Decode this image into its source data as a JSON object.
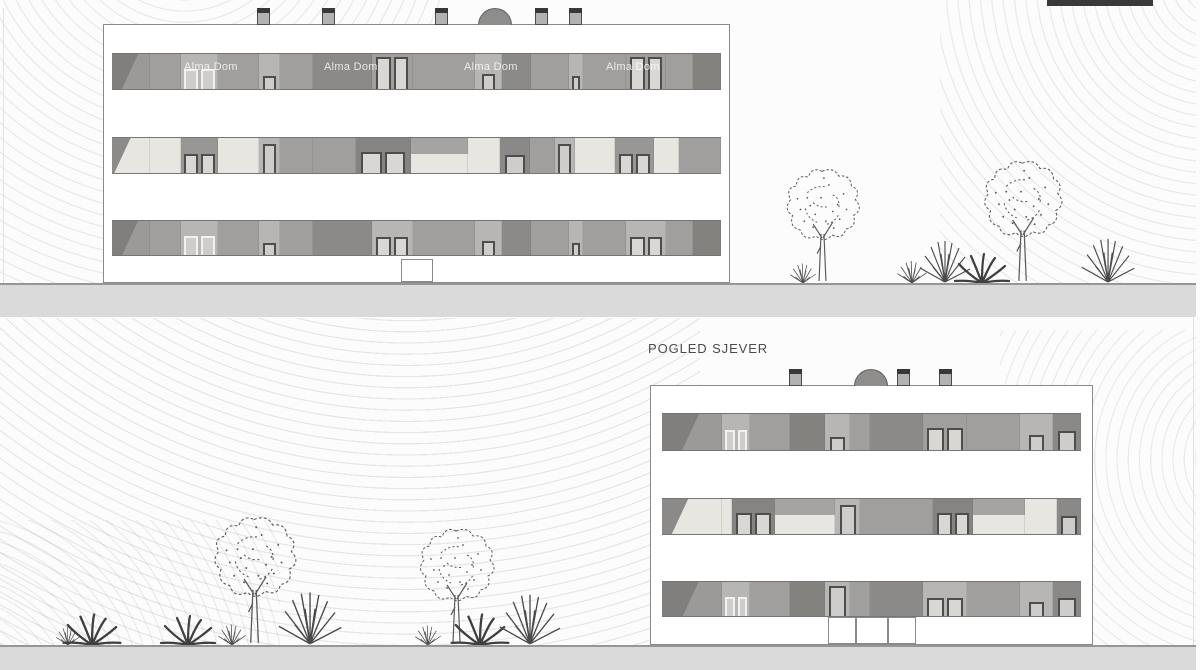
{
  "meta": {
    "view_label": "POGLED SJEVER",
    "watermark": "Alma Dom"
  },
  "palette": {
    "ground": "#dadada",
    "groundline": "#969696",
    "outline": "#8a8a8a",
    "bandline": "#757575",
    "dark": "#8b8a88",
    "med": "#a09f9d",
    "light": "#b7b6b4",
    "cream": "#e8e6e1",
    "gray": "#989795",
    "darktop": "#83827f",
    "darkstrip": "#8a8988",
    "darktopwp": "#858482",
    "framew": "#f2f1ef",
    "framed": "#4e4d4b",
    "glass": "#cecdcb",
    "glass2": "#d8d7d4",
    "cropbar": "#3a3a3a"
  },
  "ground_bands": [
    {
      "y": 283,
      "h": 34
    },
    {
      "y": 645,
      "h": 25
    }
  ],
  "label_pos": {
    "x": 648,
    "y": 341
  },
  "cropped_bar": {
    "x": 1047,
    "width": 106,
    "height": 6
  },
  "buildings": [
    {
      "name": "south-elevation",
      "left": 103,
      "top": 24,
      "width": 627,
      "height": 259,
      "inset": 8,
      "base_top": 231,
      "roof": {
        "chimneys": [
          153,
          218,
          331,
          431,
          465
        ],
        "dome": 391
      },
      "doors": [
        {
          "x": 0.474,
          "w": 0.051,
          "top": 234
        }
      ],
      "watermarks": [
        {
          "x": 80,
          "y": 36
        },
        {
          "x": 220,
          "y": 36
        },
        {
          "x": 360,
          "y": 36
        },
        {
          "x": 502,
          "y": 36
        }
      ],
      "floors": [
        {
          "y": 28,
          "h": 37,
          "segments": [
            [
              38,
              "darkdiag"
            ],
            [
              31,
              "med"
            ],
            [
              38,
              "light_wp_low"
            ],
            [
              41,
              "med"
            ],
            [
              21,
              "strip_sm"
            ],
            [
              33,
              "med"
            ],
            [
              59,
              "dark"
            ],
            [
              41,
              "wp_tall"
            ],
            [
              63,
              "med"
            ],
            [
              27,
              "light_wsm"
            ],
            [
              29,
              "dark"
            ],
            [
              38,
              "med"
            ],
            [
              14,
              "strip_sm"
            ],
            [
              44,
              "med"
            ],
            [
              40,
              "wp_tall"
            ],
            [
              27,
              "med"
            ],
            [
              28,
              "darktop"
            ]
          ]
        },
        {
          "y": 112,
          "h": 37,
          "segments": [
            [
              38,
              "creamdiag"
            ],
            [
              31,
              "cream"
            ],
            [
              38,
              "gray_wp_low"
            ],
            [
              41,
              "cream"
            ],
            [
              21,
              "strip_tl"
            ],
            [
              33,
              "med"
            ],
            [
              43,
              "med"
            ],
            [
              55,
              "darktop_wp"
            ],
            [
              58,
              "creamgray"
            ],
            [
              32,
              "cream"
            ],
            [
              30,
              "strip_mid"
            ],
            [
              25,
              "med"
            ],
            [
              20,
              "strip_tl"
            ],
            [
              40,
              "cream"
            ],
            [
              40,
              "gray_wp_low"
            ],
            [
              25,
              "cream"
            ],
            [
              42,
              "med"
            ]
          ]
        },
        {
          "y": 195,
          "h": 36,
          "segments": [
            [
              38,
              "darkdiag"
            ],
            [
              31,
              "med"
            ],
            [
              38,
              "light_wp_low"
            ],
            [
              41,
              "med"
            ],
            [
              21,
              "strip_sm"
            ],
            [
              33,
              "med"
            ],
            [
              59,
              "dark"
            ],
            [
              41,
              "wp_low_dark"
            ],
            [
              63,
              "med"
            ],
            [
              27,
              "light_wsm"
            ],
            [
              29,
              "dark"
            ],
            [
              38,
              "med"
            ],
            [
              14,
              "strip_sm"
            ],
            [
              44,
              "med"
            ],
            [
              40,
              "wp_low_dark"
            ],
            [
              27,
              "med"
            ],
            [
              28,
              "darktop"
            ]
          ]
        }
      ]
    },
    {
      "name": "north-elevation",
      "left": 650,
      "top": 385,
      "width": 443,
      "height": 260,
      "inset": 11,
      "base_top": 231,
      "roof": {
        "chimneys": [
          138,
          246,
          288
        ],
        "dome": 220
      },
      "doors": [
        {
          "x": 0.3995,
          "w": 0.0633,
          "top": 231
        },
        {
          "x": 0.4628,
          "w": 0.0722,
          "top": 231
        },
        {
          "x": 0.535,
          "w": 0.0632,
          "top": 231
        }
      ],
      "watermarks": [],
      "floors": [
        {
          "y": 27,
          "h": 38,
          "segments": [
            [
              60,
              "darkdiag"
            ],
            [
              28,
              "light_wp_low"
            ],
            [
              40,
              "med"
            ],
            [
              35,
              "darktop"
            ],
            [
              25,
              "strip_sm"
            ],
            [
              20,
              "med"
            ],
            [
              53,
              "dark"
            ],
            [
              44,
              "wp_mid"
            ],
            [
              53,
              "med"
            ],
            [
              33,
              "light_wsm"
            ],
            [
              28,
              "strip_mid"
            ]
          ]
        },
        {
          "y": 112,
          "h": 37,
          "segments": [
            [
              60,
              "creamdiag"
            ],
            [
              10,
              "cream"
            ],
            [
              43,
              "darktop_wp"
            ],
            [
              60,
              "creamgray"
            ],
            [
              25,
              "strip_tl"
            ],
            [
              73,
              "med"
            ],
            [
              40,
              "darktop_wp"
            ],
            [
              52,
              "creamgray"
            ],
            [
              32,
              "cream"
            ],
            [
              24,
              "strip_mid"
            ]
          ]
        },
        {
          "y": 195,
          "h": 36,
          "segments": [
            [
              60,
              "darkdiag"
            ],
            [
              28,
              "light_wp_low"
            ],
            [
              40,
              "med"
            ],
            [
              35,
              "darktop"
            ],
            [
              25,
              "door_tl"
            ],
            [
              20,
              "med"
            ],
            [
              53,
              "dark"
            ],
            [
              44,
              "wp_low_dark"
            ],
            [
              53,
              "med"
            ],
            [
              33,
              "light_wsm"
            ],
            [
              28,
              "strip_mid"
            ]
          ]
        }
      ]
    }
  ],
  "flora": {
    "top": {
      "ground": 283,
      "items": [
        {
          "t": "grass",
          "x": 803,
          "s": 0.75
        },
        {
          "t": "tree",
          "x": 822,
          "s": 0.98
        },
        {
          "t": "grass",
          "x": 912,
          "s": 0.85
        },
        {
          "t": "grassbig",
          "x": 945,
          "s": 1.0
        },
        {
          "t": "agave",
          "x": 982,
          "s": 1.0
        },
        {
          "t": "tree",
          "x": 1022,
          "s": 1.05
        },
        {
          "t": "grassbig",
          "x": 1108,
          "s": 1.05
        }
      ]
    },
    "bottom": {
      "ground": 645,
      "items": [
        {
          "t": "grass",
          "x": 68,
          "s": 0.7
        },
        {
          "t": "agave",
          "x": 92,
          "s": 1.05
        },
        {
          "t": "agave",
          "x": 188,
          "s": 1.0
        },
        {
          "t": "grass",
          "x": 232,
          "s": 0.8
        },
        {
          "t": "tree",
          "x": 254,
          "s": 1.1
        },
        {
          "t": "grassbig",
          "x": 310,
          "s": 1.25
        },
        {
          "t": "grass",
          "x": 428,
          "s": 0.75
        },
        {
          "t": "tree",
          "x": 456,
          "s": 1.0
        },
        {
          "t": "agave",
          "x": 480,
          "s": 1.05
        },
        {
          "t": "grassbig",
          "x": 530,
          "s": 1.2
        }
      ]
    }
  }
}
